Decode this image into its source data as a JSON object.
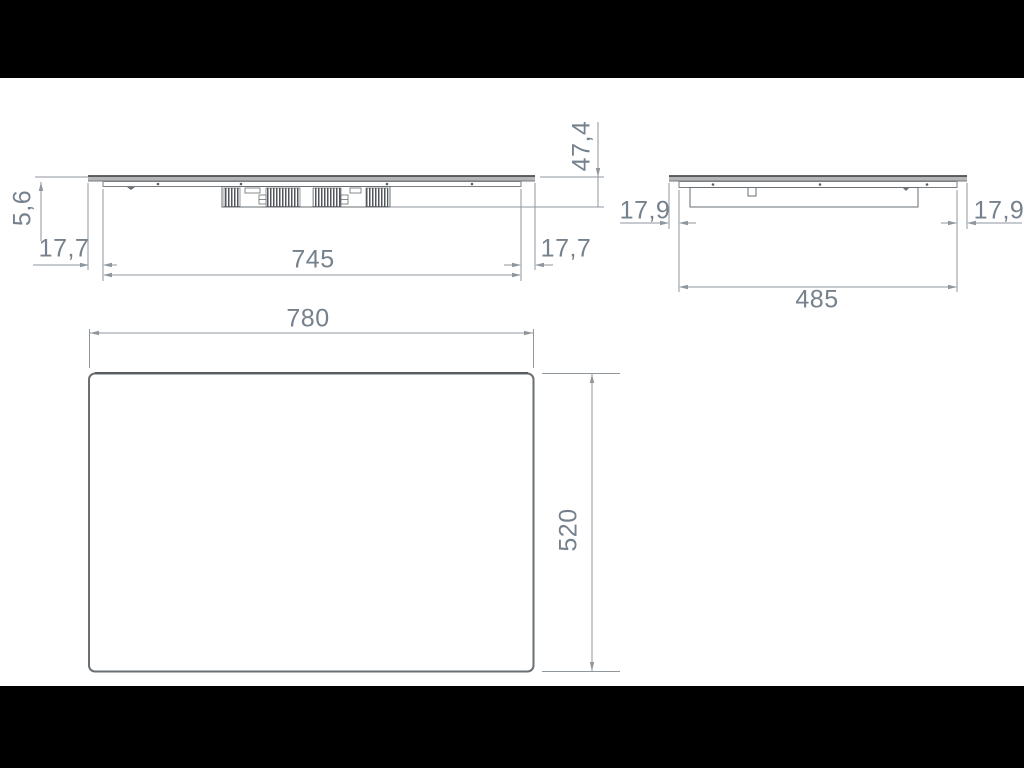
{
  "front_view": {
    "glass_thickness": "5,6",
    "overhang_left": "17,7",
    "cutout_width": "745",
    "overhang_right": "17,7",
    "total_height": "47,4"
  },
  "side_view": {
    "overhang_left": "17,9",
    "cutout_depth": "485",
    "overhang_right": "17,9"
  },
  "top_view": {
    "width": "780",
    "depth": "520"
  },
  "colors": {
    "letterbox": "#000000",
    "canvas": "#ffffff",
    "dimension_text": "#75818c",
    "dimension_line": "#8f969c",
    "outline": "#6a6f74",
    "glass_fill": "#b6b6b6"
  }
}
